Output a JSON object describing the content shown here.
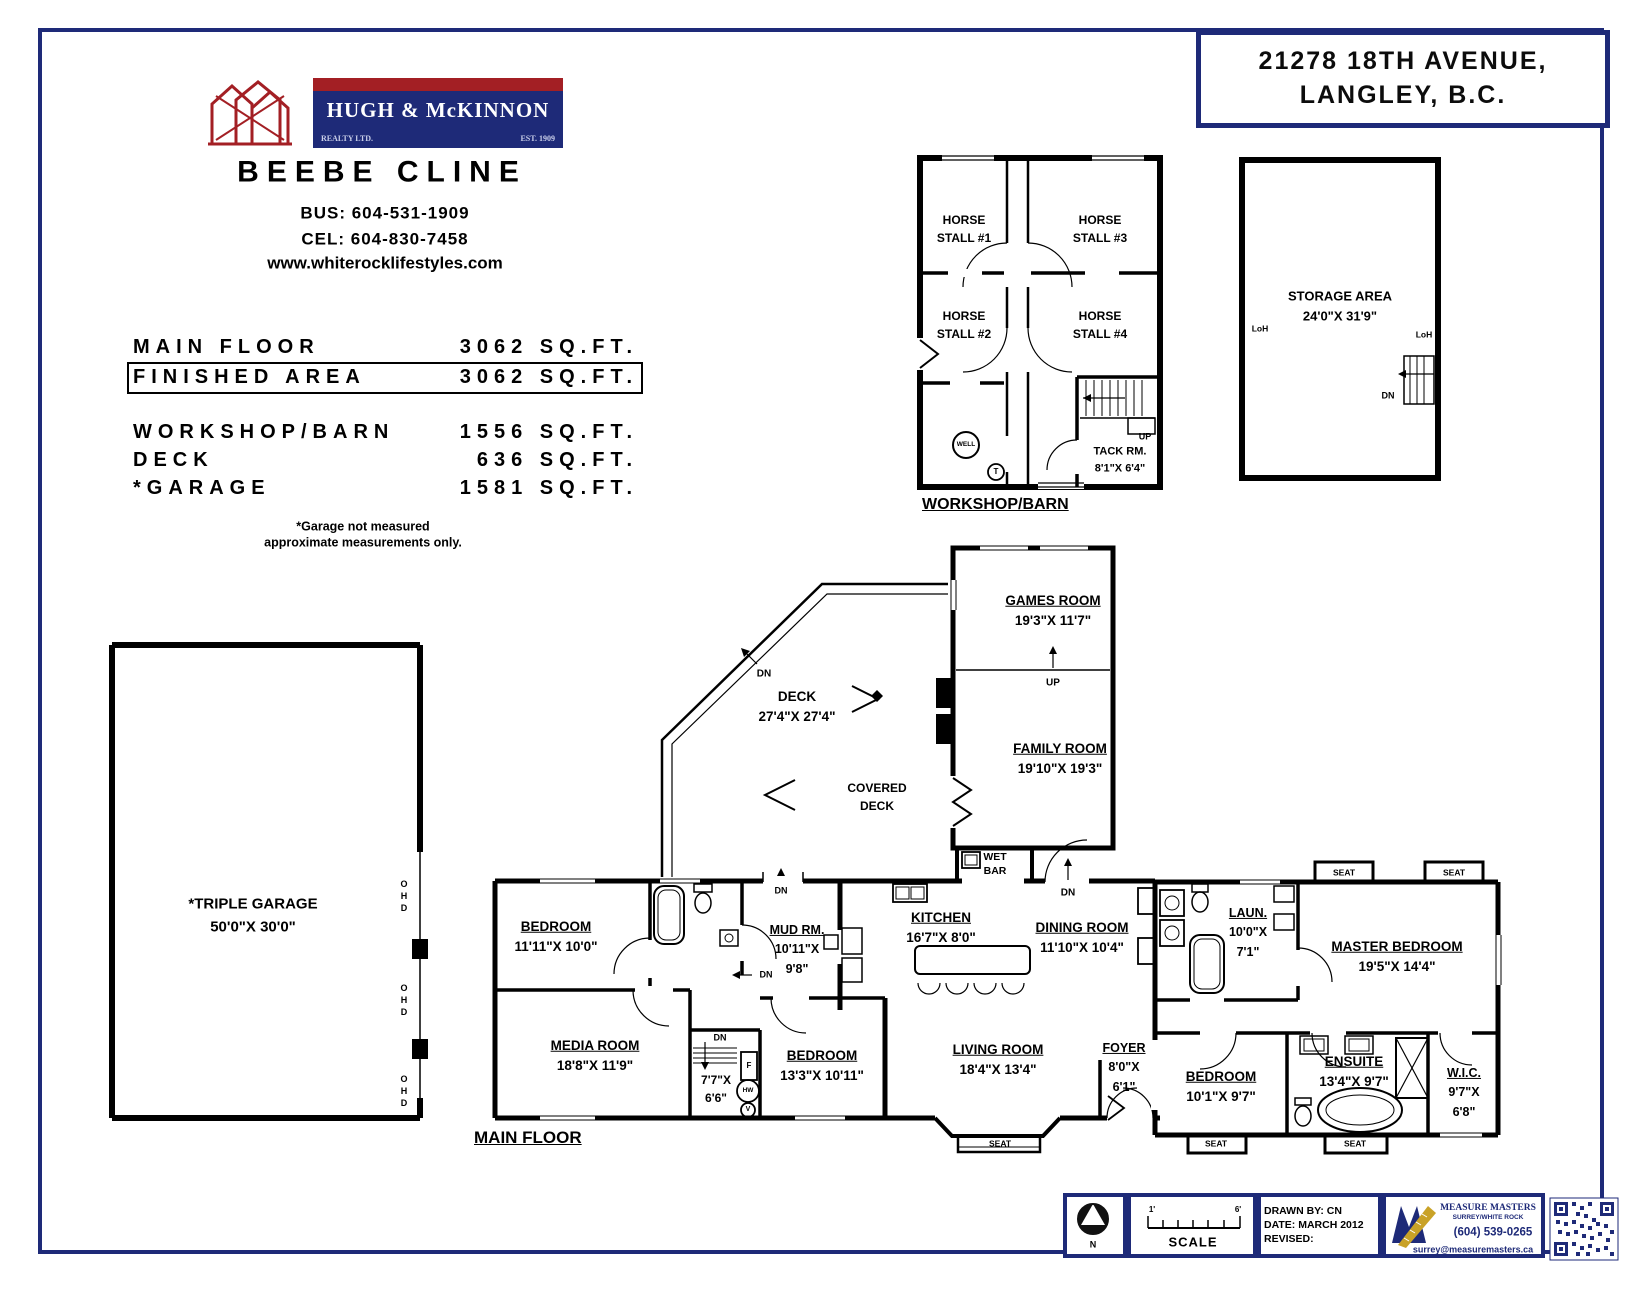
{
  "address": {
    "line1": "21278 18TH AVENUE,",
    "line2": "LANGLEY, B.C."
  },
  "brand": {
    "name": "HUGH & McKINNON",
    "realty": "REALTY LTD.",
    "est": "EST. 1909",
    "agent": "BEEBE CLINE",
    "bus": "BUS: 604-531-1909",
    "cel": "CEL: 604-830-7458",
    "web": "www.whiterocklifestyles.com"
  },
  "areas": {
    "rows": [
      {
        "label": "MAIN FLOOR",
        "value": "3062 SQ.FT."
      },
      {
        "label": "FINISHED AREA",
        "value": "3062 SQ.FT."
      },
      {
        "label": "WORKSHOP/BARN",
        "value": "1556 SQ.FT."
      },
      {
        "label": "DECK",
        "value": "636 SQ.FT."
      },
      {
        "label": "*GARAGE",
        "value": "1581 SQ.FT."
      }
    ],
    "note1": "*Garage not measured",
    "note2": "approximate measurements only."
  },
  "workshop": {
    "title": "WORKSHOP/BARN",
    "stall1a": "HORSE",
    "stall1b": "STALL #1",
    "stall2a": "HORSE",
    "stall2b": "STALL #2",
    "stall3a": "HORSE",
    "stall3b": "STALL #3",
    "stall4a": "HORSE",
    "stall4b": "STALL #4",
    "tack_name": "TACK RM.",
    "tack_dims": "8'1\"X 6'4\"",
    "well": "WELL",
    "t": "T",
    "up": "UP"
  },
  "storage": {
    "name": "STORAGE AREA",
    "dims": "24'0\"X 31'9\"",
    "loh": "LoH",
    "dn": "DN"
  },
  "garage": {
    "name": "*TRIPLE GARAGE",
    "dims": "50'0\"X 30'0\"",
    "ohd": "OHD"
  },
  "main": {
    "title": "MAIN FLOOR",
    "rooms": {
      "bedroom1": {
        "name": "BEDROOM",
        "dims": "11'11\"X 10'0\""
      },
      "media": {
        "name": "MEDIA ROOM",
        "dims": "18'8\"X 11'9\""
      },
      "mud": {
        "name": "MUD RM.",
        "dims1": "10'11\"X",
        "dims2": "9'8\""
      },
      "utility": {
        "dims1": "7'7\"X",
        "dims2": "6'6\""
      },
      "bedroom2": {
        "name": "BEDROOM",
        "dims": "13'3\"X 10'11\""
      },
      "kitchen": {
        "name": "KITCHEN",
        "dims": "16'7\"X 8'0\""
      },
      "wetbar1": "WET",
      "wetbar2": "BAR",
      "dining": {
        "name": "DINING ROOM",
        "dims": "11'10\"X 10'4\""
      },
      "living": {
        "name": "LIVING ROOM",
        "dims": "18'4\"X 13'4\""
      },
      "foyer": {
        "name": "FOYER",
        "dims1": "8'0\"X",
        "dims2": "6'1\""
      },
      "laundry": {
        "name": "LAUN.",
        "dims1": "10'0\"X",
        "dims2": "7'1\""
      },
      "master": {
        "name": "MASTER BEDROOM",
        "dims": "19'5\"X 14'4\""
      },
      "bedroom3": {
        "name": "BEDROOM",
        "dims": "10'1\"X 9'7\""
      },
      "ensuite": {
        "name": "ENSUITE",
        "dims": "13'4\"X 9'7\""
      },
      "wic": {
        "name": "W.I.C.",
        "dims1": "9'7\"X",
        "dims2": "6'8\""
      },
      "games": {
        "name": "GAMES ROOM",
        "dims": "19'3\"X 11'7\""
      },
      "family": {
        "name": "FAMILY ROOM",
        "dims": "19'10\"X 19'3\""
      },
      "deck": {
        "name": "DECK",
        "dims": "27'4\"X 27'4\""
      },
      "covered1": "COVERED",
      "covered2": "DECK"
    },
    "labels": {
      "dn": "DN",
      "up": "UP",
      "seat": "SEAT",
      "f": "F",
      "hw": "HW",
      "v": "V"
    }
  },
  "footer": {
    "north": "N",
    "scale": "SCALE",
    "scale_min": "1'",
    "scale_max": "6'",
    "drawn_by": "DRAWN BY: CN",
    "date": "DATE: MARCH 2012",
    "revised": "REVISED:",
    "company": "MEASURE MASTERS",
    "region": "SURREY/WHITE ROCK",
    "phone": "(604) 539-0265",
    "email": "surrey@measuremasters.ca"
  }
}
